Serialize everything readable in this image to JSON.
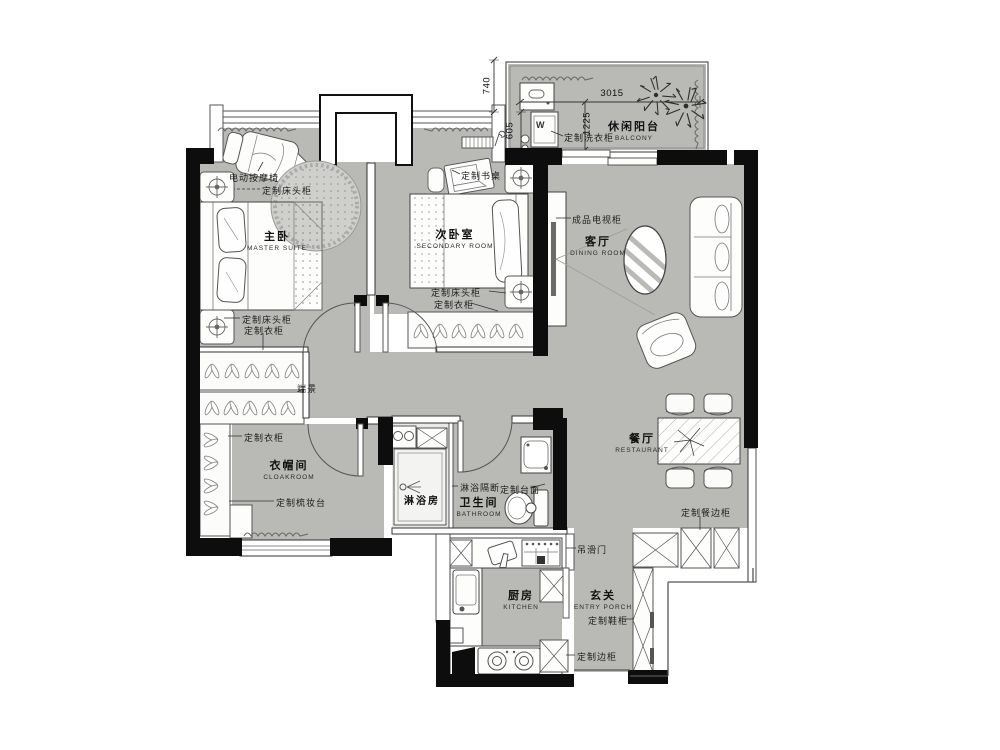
{
  "plan_title": "residential floor plan",
  "colors": {
    "floor": "#b9b9b6",
    "floor_light": "#e9e9e6",
    "wall": "#0d0d0d",
    "line": "#444444",
    "furniture": "#fcfcfb"
  },
  "rooms": {
    "master": {
      "cn": "主卧",
      "en": "MASTER SUITE"
    },
    "secondary": {
      "cn": "次卧室",
      "en": "SECONDARY ROOM"
    },
    "balcony": {
      "cn": "休闲阳台",
      "en": "BALCONY"
    },
    "living": {
      "cn": "客厅",
      "en": "DINING ROOM"
    },
    "dining": {
      "cn": "餐厅",
      "en": "RESTAURANT"
    },
    "cloakroom": {
      "cn": "衣帽间",
      "en": "CLOAKROOM"
    },
    "shower": {
      "cn": "淋浴房",
      "en": ""
    },
    "bathroom": {
      "cn": "卫生间",
      "en": "BATHROOM"
    },
    "kitchen": {
      "cn": "厨房",
      "en": "KITCHEN"
    },
    "entry": {
      "cn": "玄关",
      "en": "ENTRY PORCH"
    }
  },
  "labels": {
    "massage_chair": "电动按摩椅",
    "bedside_m1": "定制床头柜",
    "bedside_m2": "定制床头柜",
    "wardrobe_m": "定制衣柜",
    "desk": "定制书桌",
    "bedside_s": "定制床头柜",
    "wardrobe_s": "定制衣柜",
    "laundry_cabinet": "定制洗衣柜",
    "tv_cabinet": "成品电视柜",
    "wardrobe_c": "定制衣柜",
    "dressing_table": "定制梳妆台",
    "end_view": "端景",
    "shower_partition": "淋浴隔断",
    "countertop": "定制台面",
    "sideboard": "定制餐边柜",
    "sliding_door": "吊滑门",
    "shoe_cabinet": "定制鞋柜",
    "side_cabinet": "定制边柜",
    "washer": "W"
  },
  "dimensions": {
    "d740": "740",
    "d605": "605",
    "d3015": "3015",
    "d1225": "1225"
  }
}
